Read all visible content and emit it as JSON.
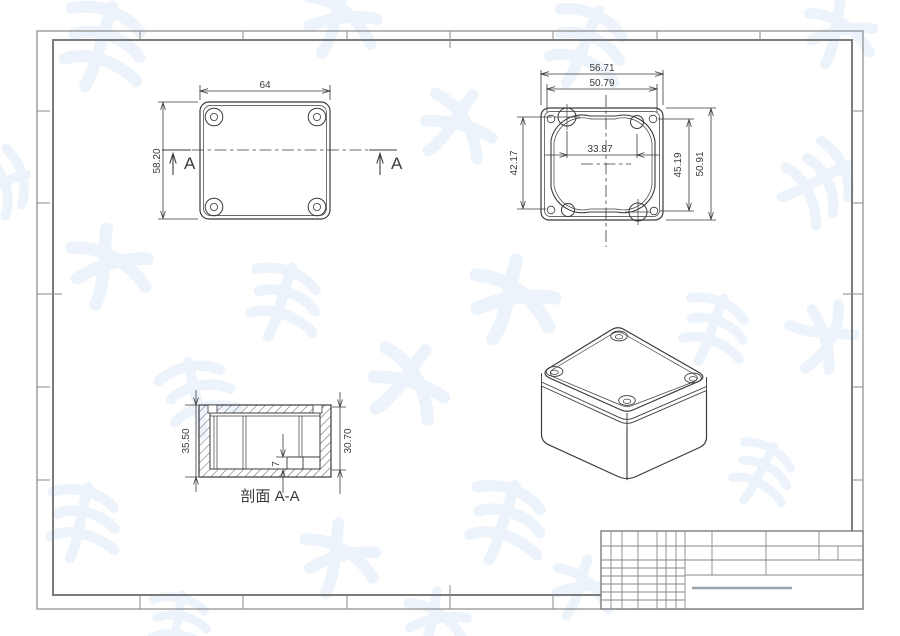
{
  "document": {
    "type_note": "engineering drawing of a plastic enclosure, four views, empty title block"
  },
  "colors": {
    "line": "#3b3b3b",
    "border": "#8a8a8a",
    "inner_border": "#7c7c7c",
    "title_block_line": "#8a8a8a",
    "signature_line": "#9aa4ad",
    "watermark": "#d9e6f4",
    "background": "#ffffff"
  },
  "views": {
    "plan": {
      "name": "top-view",
      "dim_width": "64",
      "dim_height": "58.20",
      "section_marker": "A"
    },
    "bottom": {
      "name": "bottom-inside-view",
      "dim_outer_width": "56.71",
      "dim_mid_width": "50.79",
      "dim_boss_width": "33.87",
      "dim_left_height": "42.17",
      "dim_right_height_inner": "45.19",
      "dim_right_height_outer": "50.91"
    },
    "section": {
      "name": "section-view",
      "label": "剖面 A-A",
      "dim_outer_height": "35.50",
      "dim_inner_height": "30.70",
      "dim_step": "7"
    },
    "isometric": {
      "name": "isometric-view"
    }
  }
}
